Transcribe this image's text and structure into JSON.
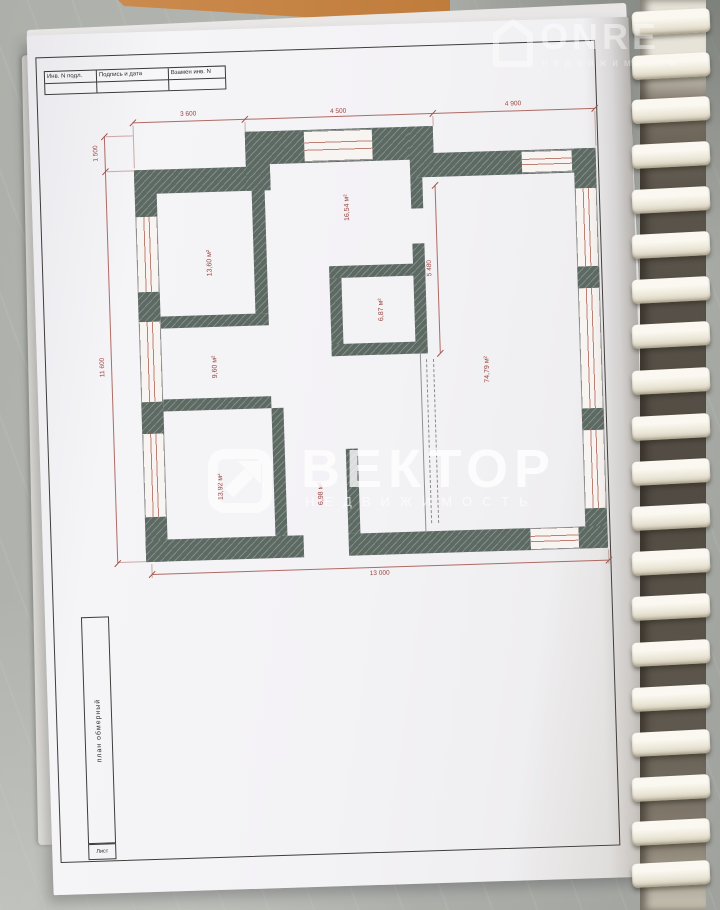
{
  "stamp": {
    "cells": [
      "Инв. N подл.",
      "Подпись и дата",
      "Взамен инв. N"
    ]
  },
  "plan": {
    "rooms": [
      {
        "area": "13,60 м²"
      },
      {
        "area": "9,60 м²"
      },
      {
        "area": "13,92 м²"
      },
      {
        "area": "16,54 м²"
      },
      {
        "area": "6,87 м²"
      },
      {
        "area": "6,98 м²"
      },
      {
        "area": "74,79 м²"
      }
    ],
    "dims": {
      "top": [
        "3 600",
        "4 500",
        "4 900"
      ],
      "left_offset": "1 500",
      "left_total": "11 600",
      "inner_vertical": "5 480",
      "bottom_total": "13 000"
    }
  },
  "title_block": {
    "plan_label": "план обмерный",
    "sheet_label": "Лист"
  },
  "watermarks": {
    "center": {
      "title": "ВЕКТОР",
      "subtitle": "НЕДВИЖИМОСТЬ"
    },
    "top_right": {
      "title": "ONRE",
      "subtitle": "недвижимость"
    }
  },
  "colors": {
    "wall": "#5d6963",
    "dimension_red": "#a3524a",
    "paper": "#f3f2f5",
    "table": "#b2b4b0",
    "binding_ring": "#f0ecdf"
  }
}
